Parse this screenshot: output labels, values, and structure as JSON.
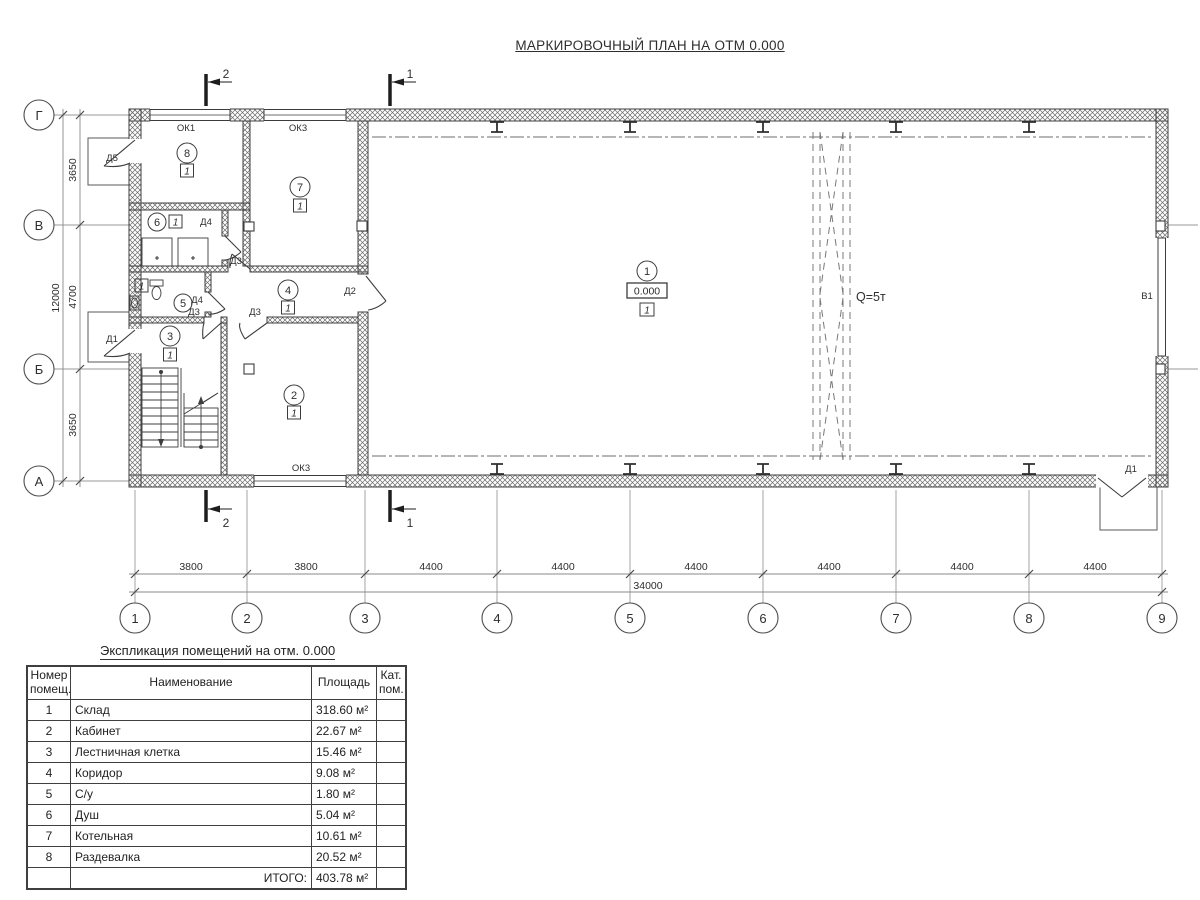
{
  "page_title": "МАРКИРОВОЧНЫЙ ПЛАН НА ОТМ 0.000",
  "plan": {
    "rooms": [
      {
        "number": "1",
        "category": "1",
        "elevation": "0.000"
      },
      {
        "number": "2",
        "category": "1"
      },
      {
        "number": "3",
        "category": "1"
      },
      {
        "number": "4",
        "category": "1"
      },
      {
        "number": "5",
        "category": "1"
      },
      {
        "number": "6",
        "category": "1"
      },
      {
        "number": "7",
        "category": "1"
      },
      {
        "number": "8",
        "category": "1"
      }
    ],
    "crane_capacity": "Q=5т",
    "gate": "В1",
    "windows": {
      "ok1": "ОК1",
      "ok3_top": "ОК3",
      "ok3_bottom": "ОК3"
    },
    "doors": {
      "d5": "Д5",
      "d4_shower": "Д4",
      "d4_wc": "Д4",
      "d3_hall": "Д3",
      "d3_stairs": "Д3",
      "d3_office": "Д3",
      "d2": "Д2",
      "d1_left": "Д1",
      "d1_bottom": "Д1"
    },
    "sections": {
      "s1": "1",
      "s2": "2"
    },
    "axes_bottom": [
      "1",
      "2",
      "3",
      "4",
      "5",
      "6",
      "7",
      "8",
      "9"
    ],
    "axes_left": [
      "Г",
      "В",
      "Б",
      "А"
    ],
    "dims_bottom": [
      "3800",
      "3800",
      "4400",
      "4400",
      "4400",
      "4400",
      "4400",
      "4400"
    ],
    "dim_bottom_total": "34000",
    "dims_left": [
      "3650",
      "4700",
      "3650"
    ],
    "dim_left_total": "12000"
  },
  "schedule": {
    "title": "Экспликация помещений на отм. 0.000",
    "columns": {
      "number": [
        "Номер",
        "помещ."
      ],
      "name": "Наименование",
      "area": "Площадь",
      "category": [
        "Кат.",
        "пом."
      ]
    },
    "rows": [
      {
        "number": "1",
        "name": "Склад",
        "area": "318.60 м²"
      },
      {
        "number": "2",
        "name": "Кабинет",
        "area": "22.67 м²"
      },
      {
        "number": "3",
        "name": "Лестничная клетка",
        "area": "15.46 м²"
      },
      {
        "number": "4",
        "name": "Коридор",
        "area": "9.08 м²"
      },
      {
        "number": "5",
        "name": "С/у",
        "area": "1.80 м²"
      },
      {
        "number": "6",
        "name": "Душ",
        "area": "5.04 м²"
      },
      {
        "number": "7",
        "name": "Котельная",
        "area": "10.61 м²"
      },
      {
        "number": "8",
        "name": "Раздевалка",
        "area": "20.52 м²"
      }
    ],
    "total_label": "ИТОГО:",
    "total_area": "403.78 м²"
  }
}
